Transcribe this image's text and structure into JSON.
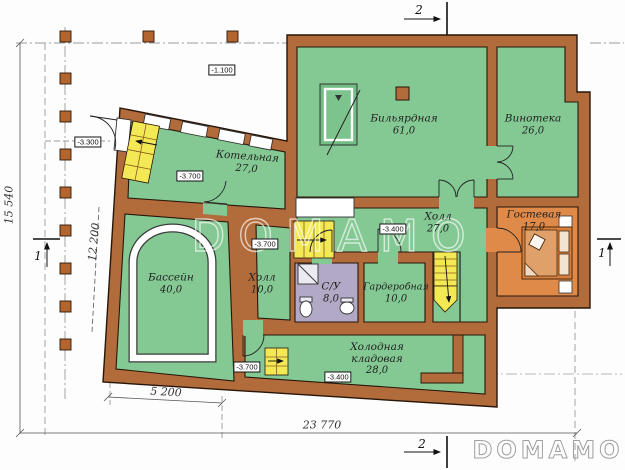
{
  "plan": {
    "title": "Basement floor plan",
    "rooms": [
      {
        "name": "Бильярдная",
        "area": "61,0"
      },
      {
        "name": "Винотека",
        "area": "26,0"
      },
      {
        "name": "Котельная",
        "area": "27,0"
      },
      {
        "name": "Холл",
        "area": "27,0"
      },
      {
        "name": "Гостевая",
        "area": "17,0"
      },
      {
        "name": "Бассейн",
        "area": "40,0"
      },
      {
        "name": "Холл",
        "area": "10,0"
      },
      {
        "name": "С/У",
        "area": "8,0"
      },
      {
        "name": "Гардеробная",
        "area": "10,0"
      },
      {
        "name": "Холодная",
        "name2": "кладовая",
        "area": "28,0"
      }
    ],
    "elevations": {
      "terrace": "-1.100",
      "entry": "-3.300",
      "boiler": "-3.700",
      "hall_mid": "-3.700",
      "bottom": "-3.700",
      "hall": "-3.400",
      "cold": "-3.400"
    },
    "dimensions": {
      "total_width": "23 770",
      "total_height": "15 540",
      "pool_side": "12 200",
      "pool_bottom": "5 200"
    },
    "sections": {
      "s1": "1",
      "s2": "2"
    },
    "watermark": "DOMAMO",
    "logo": "DOMAMO",
    "colors": {
      "wall": "#b26b3a",
      "room_green": "#84c893",
      "guest_orange": "#df8a49",
      "bath_purple": "#b2a9c6",
      "stairs_yellow": "#f2e955",
      "bed_orange": "#d9813c"
    }
  }
}
